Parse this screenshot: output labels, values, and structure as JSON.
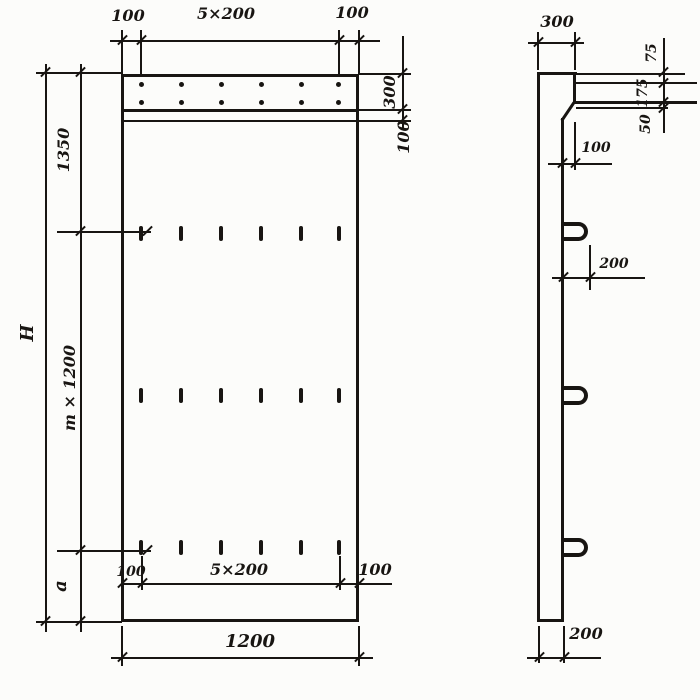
{
  "front_view": {
    "top_dims": {
      "left": "100",
      "center": "5×200",
      "right": "100"
    },
    "right_dims": {
      "band": "300",
      "gap": "100"
    },
    "left_dims": {
      "top": "1350",
      "height": "H",
      "module": "m × 1200",
      "bottom": "a"
    },
    "bottom_dims": {
      "left": "100",
      "center": "5×200",
      "right": "100",
      "width": "1200"
    }
  },
  "side_view": {
    "top_dim": "300",
    "right_dims": {
      "top": "75",
      "middle": "175",
      "bottom": "50"
    },
    "ledge_dim": "100",
    "loop_dim": "200",
    "bottom_dim": "200"
  }
}
